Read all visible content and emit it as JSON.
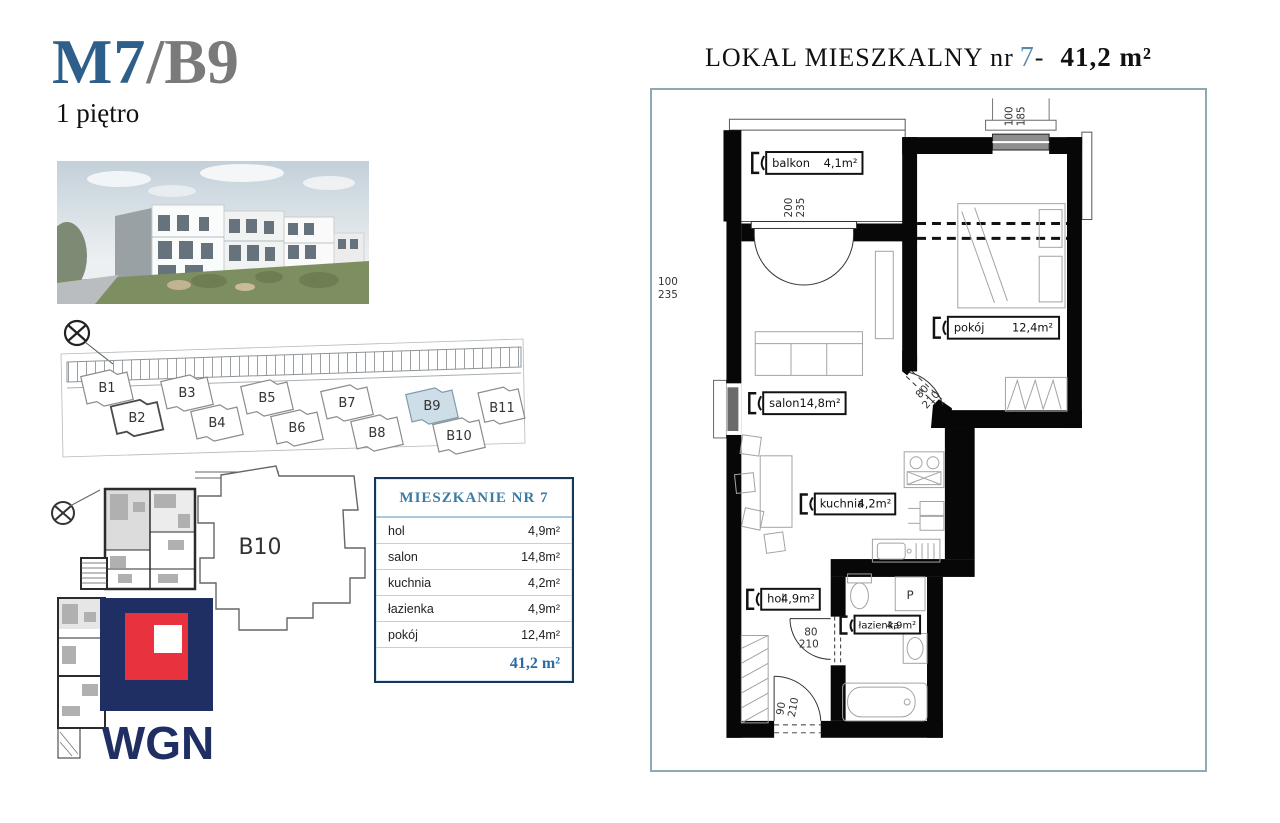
{
  "unit": {
    "code": "M7",
    "building": "/B9",
    "floor": "1 piętro"
  },
  "plan_header": {
    "prefix": "LOKAL MIESZKALNY nr",
    "number": "7",
    "separator": "-",
    "total_area": "41,2 m²"
  },
  "summary_table": {
    "title": "MIESZKANIE NR 7",
    "rows": [
      {
        "name": "hol",
        "area": "4,9m²"
      },
      {
        "name": "salon",
        "area": "14,8m²"
      },
      {
        "name": "kuchnia",
        "area": "4,2m²"
      },
      {
        "name": "łazienka",
        "area": "4,9m²"
      },
      {
        "name": "pokój",
        "area": "12,4m²"
      }
    ],
    "total_area": "41,2 m²"
  },
  "floor_plan": {
    "rooms": {
      "balkon": {
        "name": "balkon",
        "area": "4,1m²"
      },
      "pokoj": {
        "name": "pokój",
        "area": "12,4m²"
      },
      "salon": {
        "name": "salon",
        "area": "14,8m²"
      },
      "kuchnia": {
        "name": "kuchnia",
        "area": "4,2m²"
      },
      "hol": {
        "name": "hol",
        "area": "4,9m²"
      },
      "lazienka": {
        "name": "łazienka",
        "area": "4,9m²"
      }
    },
    "dimensions": {
      "top_window": {
        "w": "100",
        "h": "185"
      },
      "balcony_door": {
        "w": "200",
        "h": "235"
      },
      "side_window": {
        "w": "100",
        "h": "235"
      },
      "pokoj_door": {
        "w": "80",
        "h": "210"
      },
      "bath_door": {
        "w": "80",
        "h": "210"
      },
      "entry_door": {
        "w": "90",
        "h": "210"
      }
    },
    "washer_label": "P"
  },
  "site_plan": {
    "buildings": [
      "B1",
      "B2",
      "B3",
      "B4",
      "B5",
      "B6",
      "B7",
      "B8",
      "B9",
      "B10",
      "B11"
    ],
    "highlighted": "B9"
  },
  "b10_outline": {
    "label": "B10"
  },
  "logo": {
    "text": "WGN"
  },
  "colors": {
    "unit_code_blue": "#2e5f8a",
    "unit_building_gray": "#7a7a7a",
    "header_number_blue": "#5d89a8",
    "table_accent_blue": "#2a6ba3",
    "logo_navy": "#1f2f63",
    "logo_red": "#e8333f",
    "site_highlight_fill": "#cddee9"
  }
}
